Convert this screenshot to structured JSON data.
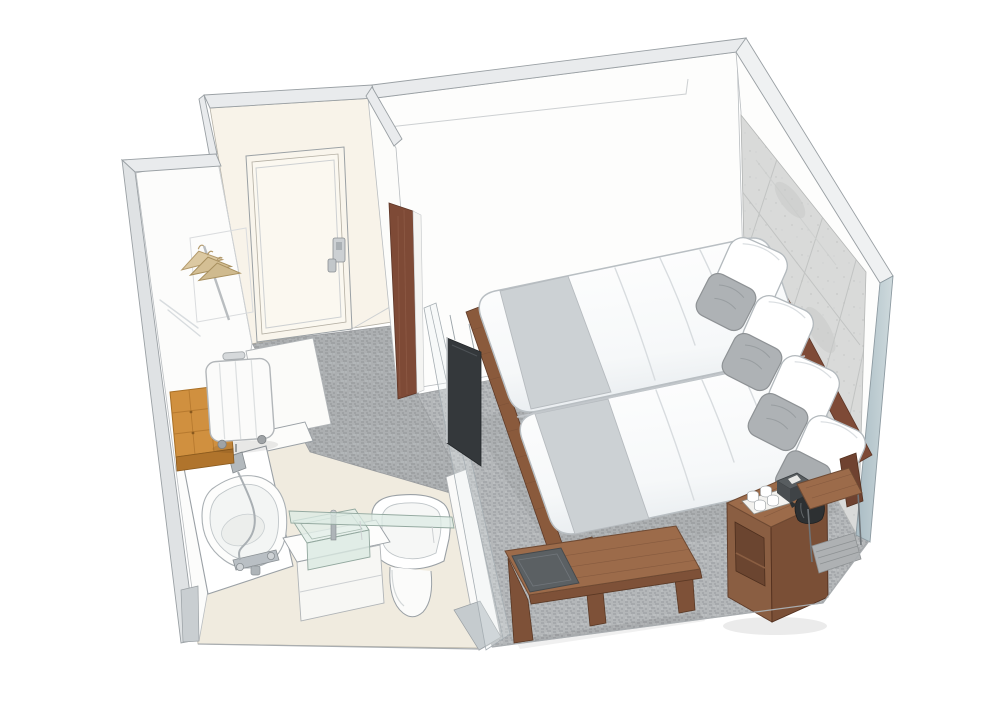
{
  "scene": {
    "type": "axonometric-cutaway-illustration",
    "subject": "Hotel guest room with en-suite bathroom, hand-rendered isometric cutaway",
    "rooms": [
      {
        "name": "Bathroom",
        "items": [
          "bathtub",
          "handheld shower",
          "bath mixer faucet",
          "glass vessel sink",
          "sink faucet",
          "glass shelf",
          "wall-hung toilet",
          "vanity cabinet",
          "tufted ottoman",
          "suitcase"
        ]
      },
      {
        "name": "Entry",
        "items": [
          "entrance door",
          "key-card door lock",
          "coat hangers",
          "hanger rail",
          "walnut wall panel",
          "corridor carpet"
        ]
      },
      {
        "name": "Bedroom",
        "items": [
          "twin beds on wood platform",
          "white duvets",
          "gray bed runners",
          "white pillows",
          "gray accent pillows",
          "wood headboard rail",
          "stone accent wall",
          "wall-mounted tv",
          "glass partition",
          "wood bench table",
          "luggage tray",
          "nightstand",
          "tea tray with cups",
          "black kettle",
          "tissue box",
          "side shelf",
          "gray carpet"
        ]
      }
    ]
  },
  "palette": {
    "paper": "#ffffff",
    "wall": "#fdfdfc",
    "wall_warm": "#f8f3e9",
    "band": "#e9ebed",
    "band_edge": "#9aa0a4",
    "cut_blue": "#aebfc6",
    "carpet": "#b4b7b9",
    "stone": "#d9dad9",
    "walnut": "#7e4a36",
    "wood": "#9c6b4a",
    "wood_dark": "#7e5138",
    "runner": "#ccd1d4",
    "pillow_gray": "#aeb2b5",
    "floor_beige": "#f0ebdf",
    "glass": "#dcebe4",
    "metal": "#b9bfc4",
    "tan": "#d0903f",
    "tan_dark": "#b0742c",
    "tray": "#5b6063",
    "kettle": "#2d3032",
    "tv": "#34383b",
    "hanger": "#dcc9a2"
  }
}
